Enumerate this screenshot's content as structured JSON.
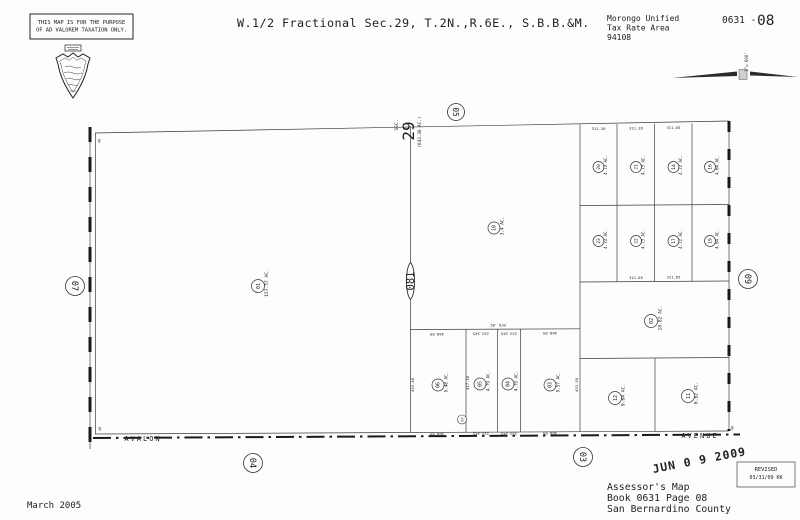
{
  "header": {
    "disclaimer_line1": "THIS MAP IS FOR THE PURPOSE",
    "disclaimer_line2": "OF AD VALOREM TAXATION ONLY.",
    "title": "W.1/2 Fractional Sec.29, T.2N.,R.6E., S.B.B.&M.",
    "district": "Morongo Unified",
    "tax_rate_area_label": "Tax Rate Area",
    "tax_rate_area_code": "94108",
    "book_prefix": "0631 -",
    "page_number": "08",
    "scale_label": "1\"= 600'"
  },
  "map": {
    "section_prefix": "SEC.",
    "section_number": "29",
    "section_acreage": "(643.30 AC.)",
    "block_oval": "081",
    "page_refs": {
      "top": "05",
      "left": "07",
      "right": "09",
      "bottom_left": "04",
      "bottom_right": "03"
    },
    "roads": {
      "west_avenue": "AVALON",
      "east_avenue": "AVENUE"
    },
    "parcels": {
      "west": {
        "num": "01",
        "ac": "157.57 AC."
      },
      "center": {
        "num": "10",
        "ac": "3.4 AC."
      },
      "strip_row1": [
        {
          "num": "20",
          "ac": "4.73 AC."
        },
        {
          "num": "21",
          "ac": "4.73 AC."
        },
        {
          "num": "14",
          "ac": "4.72 AC."
        },
        {
          "num": "16",
          "ac": "4.64 AC."
        }
      ],
      "strip_row2": [
        {
          "num": "23",
          "ac": "4.73 AC."
        },
        {
          "num": "22",
          "ac": "4.73 AC."
        },
        {
          "num": "17",
          "ac": "4.72 AC."
        },
        {
          "num": "19",
          "ac": "4.64 AC."
        }
      ],
      "south_mid": [
        {
          "num": "06",
          "ac": "9.48 AC."
        },
        {
          "num": "05",
          "ac": "4.79 AC."
        },
        {
          "num": "04",
          "ac": "4.79 AC."
        },
        {
          "num": "03",
          "ac": "9.57 AC."
        }
      ],
      "large_east": {
        "num": "02",
        "ac": "18.82 AC."
      },
      "south_east": [
        {
          "num": "12",
          "ac": "9.64 AC."
        },
        {
          "num": "11",
          "ac": "8.62 AC."
        }
      ],
      "tiny": {
        "num": "07"
      }
    },
    "dims": {
      "strip_top": [
        "311.26",
        "311.26",
        "311.65"
      ],
      "strip_bottom": [
        "311.65",
        "311.65"
      ],
      "south_top": [
        "468.99",
        "233.245",
        "233.245",
        "468.99"
      ],
      "south_bottom": [
        "468.99",
        "233.245",
        "233.245",
        "468.99"
      ],
      "south_vert": [
        "433.38",
        "417.38",
        "433.38"
      ],
      "corner_ticks": [
        "40",
        "40",
        "40"
      ],
      "easement": "50' R/W"
    }
  },
  "footer": {
    "date": "March 2005",
    "assessor_line1": "Assessor's Map",
    "assessor_line2": "Book 0631 Page 08",
    "assessor_line3": "San Bernardino County",
    "stamp": "JUN 0 9 2009",
    "revised_label": "REVISED",
    "revised_date": "03/31/09 KK"
  }
}
